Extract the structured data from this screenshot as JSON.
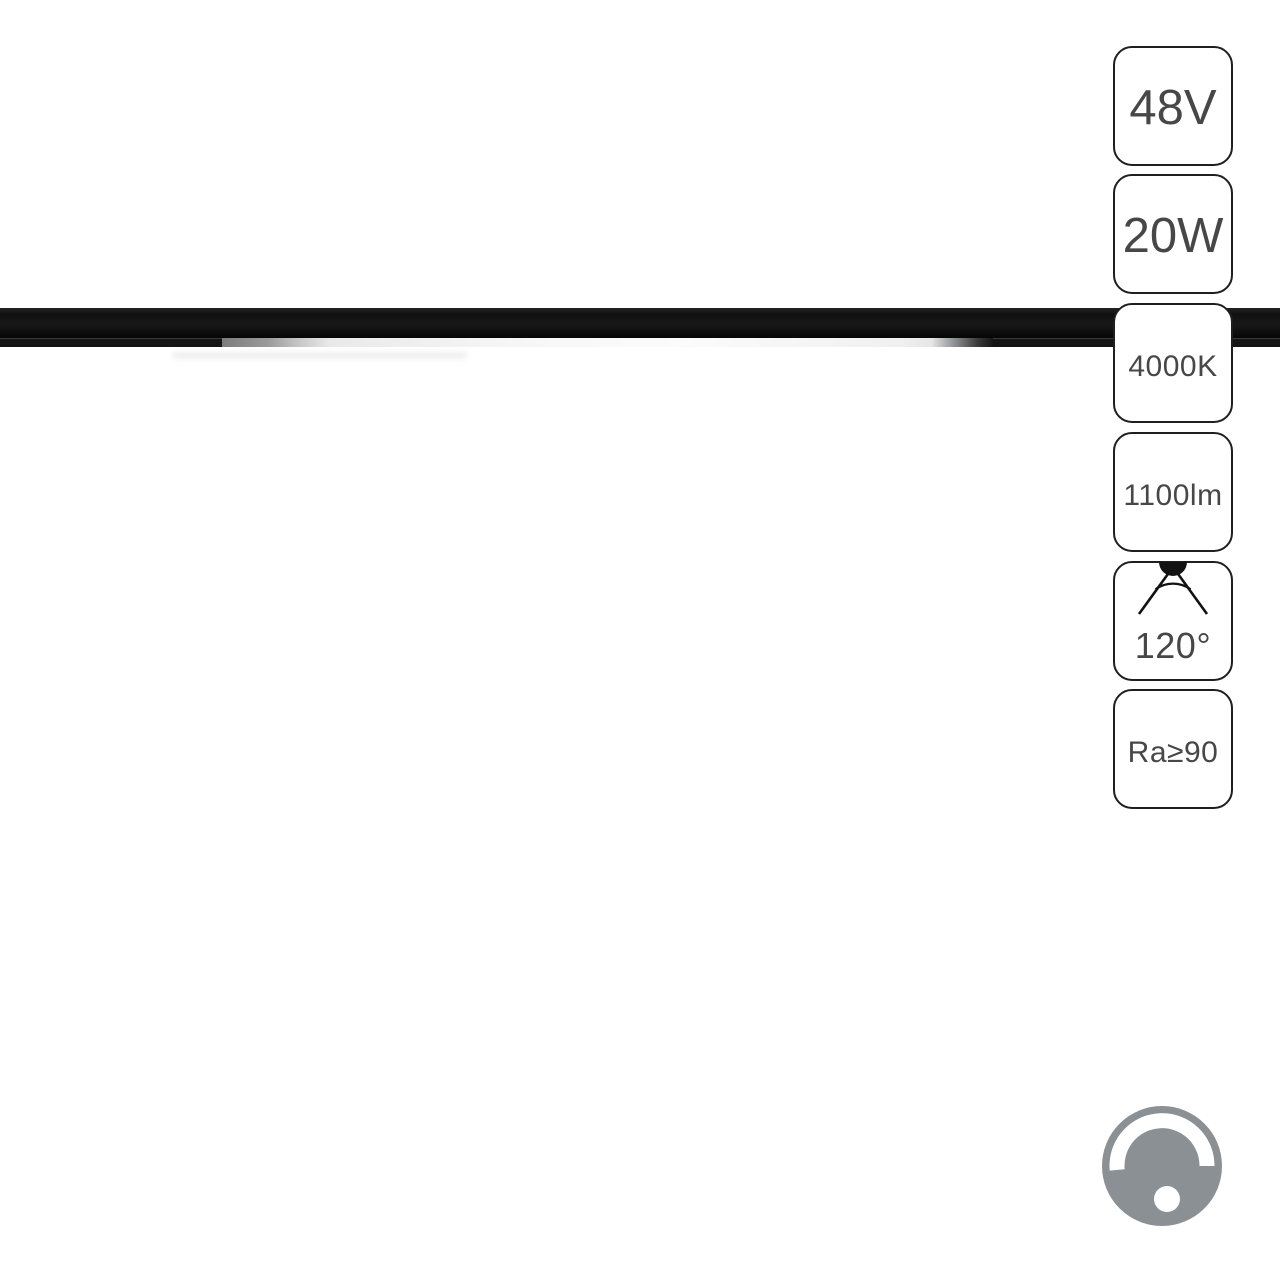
{
  "spec_badges": [
    {
      "id": "voltage",
      "label": "48V",
      "size": "large"
    },
    {
      "id": "wattage",
      "label": "20W",
      "size": "large"
    },
    {
      "id": "color_temperature",
      "label": "4000K",
      "size": "small"
    },
    {
      "id": "luminous_flux",
      "label": "1100lm",
      "size": "small"
    },
    {
      "id": "beam_angle",
      "label": "120°",
      "size": "medium",
      "icon": "beam-angle-icon"
    },
    {
      "id": "color_rendering_index",
      "label": "Ra≥90",
      "size": "small"
    }
  ],
  "footer_icon": {
    "name": "dimmer-knob-icon",
    "meaning": "dimmable"
  },
  "colors": {
    "background": "#ffffff",
    "track_black": "#121212",
    "light_strip_white": "#f6f6f6",
    "badge_border": "#1f1f1f",
    "badge_text": "#474747",
    "dimmer_gray": "#8b9095"
  }
}
